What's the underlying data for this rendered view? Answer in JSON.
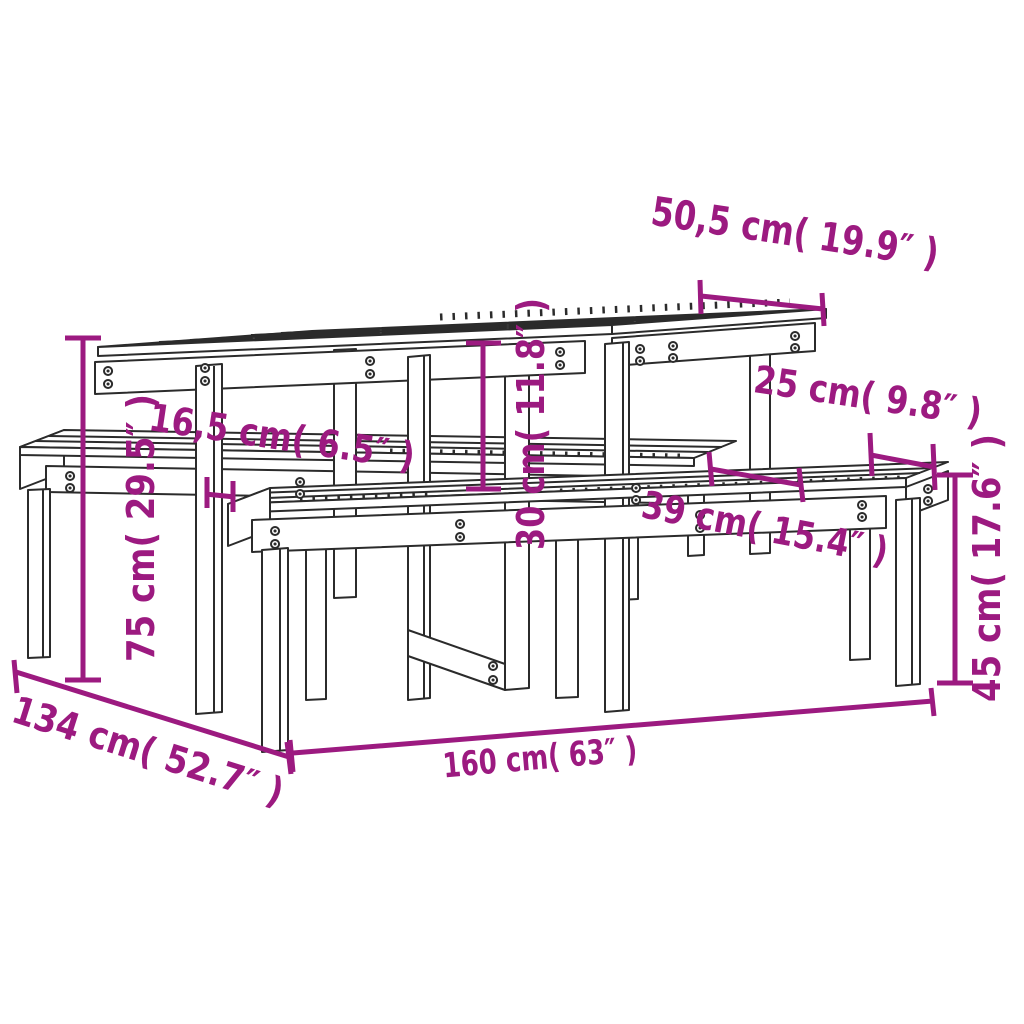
{
  "figure": {
    "title": "Picnic table with two benches — dimension diagram",
    "background_color": "#ffffff",
    "line_color": "#2b2b2b",
    "dimension_color": "#9c1a80"
  },
  "labels": {
    "tabletop_depth": "50,5 cm( 19.9″ )",
    "bench_seat_depth": "25 cm( 9.8″ )",
    "leg_inset": "16,5 cm( 6.5″ )",
    "table_to_bench_clearance": "30 cm( 11.8″ )",
    "bench_offset": "39 cm( 15.4″ )",
    "table_height": "75 cm( 29.5″ )",
    "bench_height": "45 cm( 17.6″ )",
    "total_depth": "134 cm( 52.7″ )",
    "total_length": "160 cm( 63″ )"
  }
}
